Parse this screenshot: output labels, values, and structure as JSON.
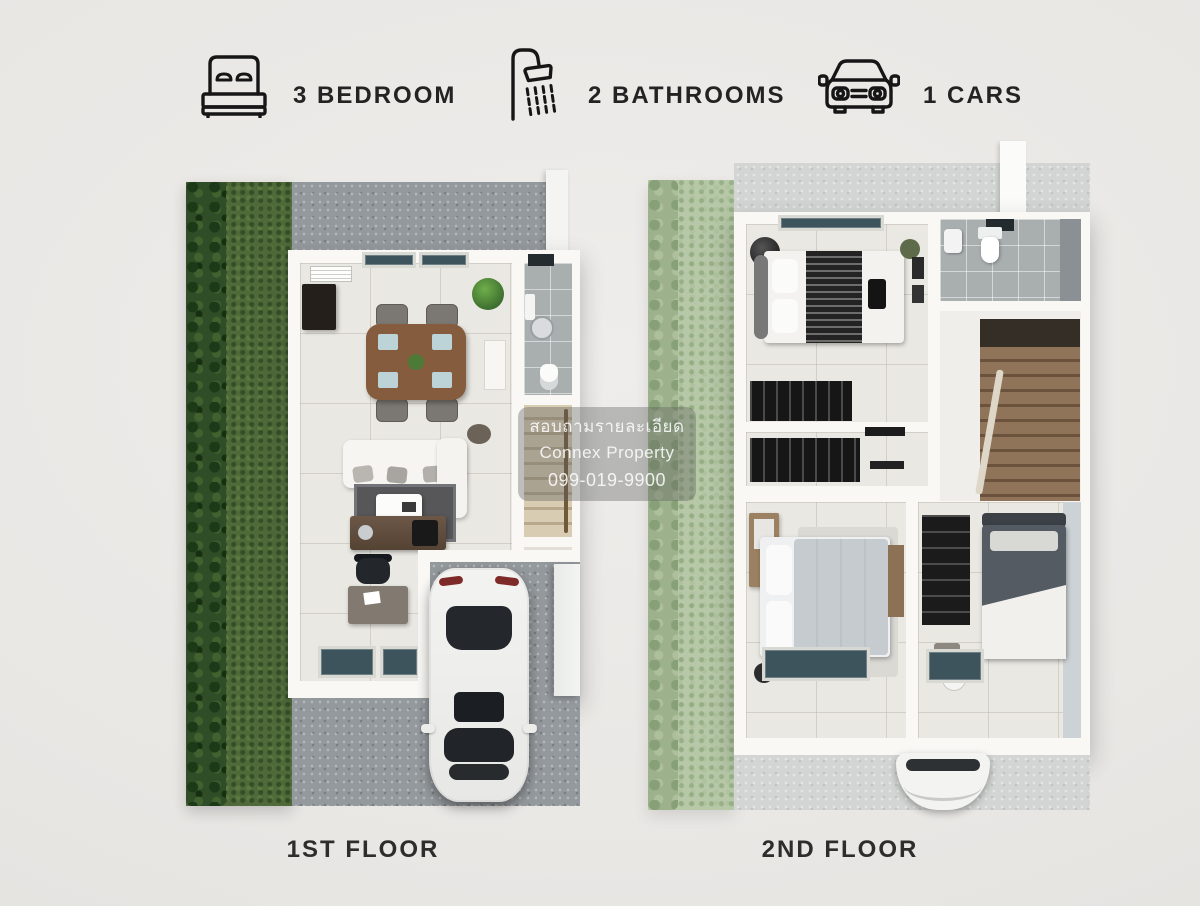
{
  "header": {
    "features": [
      {
        "icon": "bed-icon",
        "label": "3 BEDROOM"
      },
      {
        "icon": "shower-icon",
        "label": "2 BATHROOMS"
      },
      {
        "icon": "car-icon",
        "label": "1 CARS"
      }
    ]
  },
  "floor_plans": [
    {
      "label": "1ST FLOOR",
      "rooms": [
        "garden",
        "living-dining room",
        "kitchen",
        "bathroom",
        "staircase",
        "carport with car",
        "driveway"
      ]
    },
    {
      "label": "2ND FLOOR",
      "rooms": [
        "bedroom 2",
        "walk-in wardrobe",
        "bathroom",
        "staircase",
        "master bedroom",
        "bedroom 3"
      ]
    }
  ],
  "watermark": {
    "lines": [
      "สอบถามรายละเอียด",
      "Connex Property",
      "099-019-9900"
    ]
  },
  "colors": {
    "page_bg": "#e9e7e4",
    "grass": "#4f6939",
    "hedge": "#2f4d27",
    "grass_faded": "#b6c8a7",
    "concrete": "#94999d",
    "concrete_faded": "#d2d5d3",
    "wall_white": "#f9f8f5",
    "floor_tile": "#eae8e2",
    "window_glass": "#3e545c",
    "dining_wood": "#855d3e",
    "stairs_wood": "#8f745a",
    "watermark_bg": "rgba(95,97,95,0.38)",
    "text_dark": "#232323"
  }
}
